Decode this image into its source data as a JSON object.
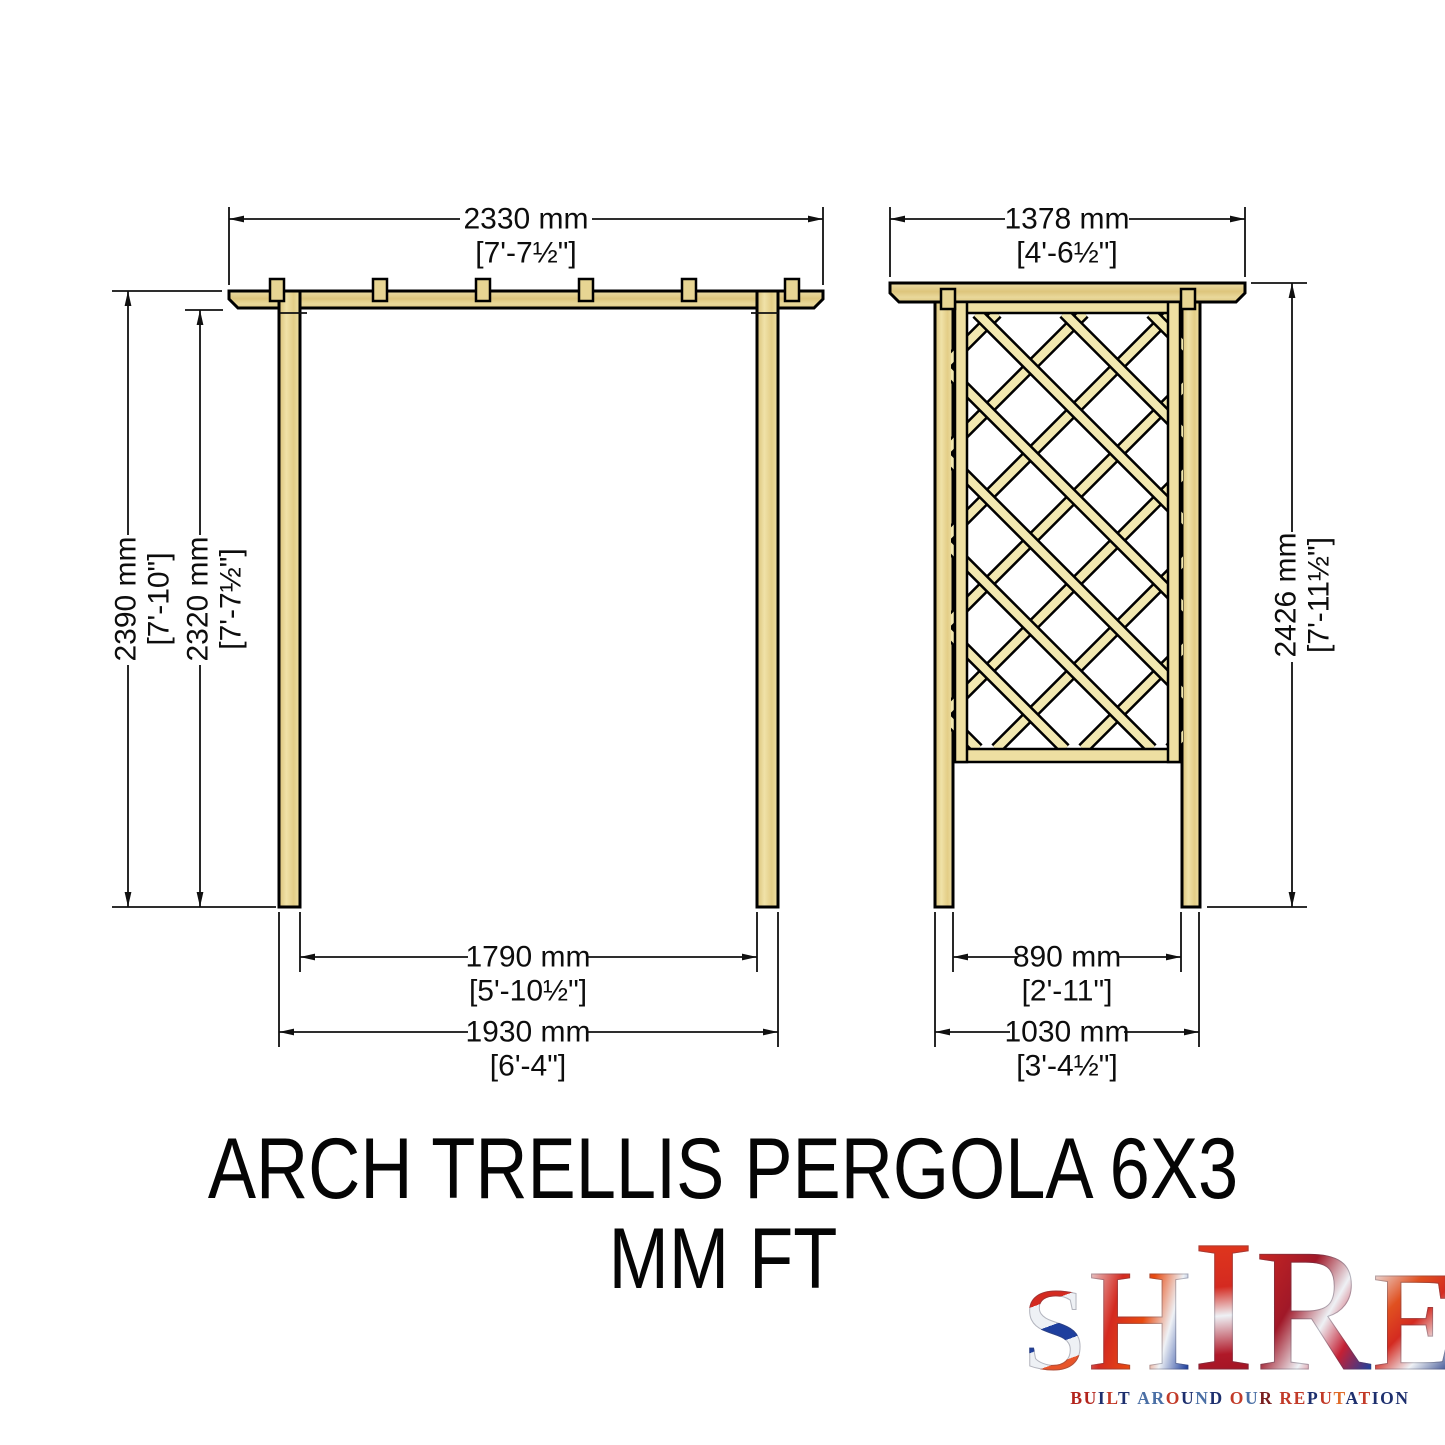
{
  "drawing": {
    "front_view": {
      "name": "pergola front elevation",
      "dim_top_width_mm": "2330 mm",
      "dim_top_width_ft": "[7'-7½\"]",
      "dim_height_outer_mm": "2390 mm",
      "dim_height_outer_ft": "[7'-10\"]",
      "dim_height_inner_mm": "2320 mm",
      "dim_height_inner_ft": "[7'-7½\"]",
      "dim_span_inner_mm": "1790 mm",
      "dim_span_inner_ft": "[5'-10½\"]",
      "dim_span_outer_mm": "1930 mm",
      "dim_span_outer_ft": "[6'-4\"]"
    },
    "side_view": {
      "name": "pergola side elevation with trellis",
      "dim_top_width_mm": "1378 mm",
      "dim_top_width_ft": "[4'-6½\"]",
      "dim_height_mm": "2426 mm",
      "dim_height_ft": "[7'-11½\"]",
      "dim_span_inner_mm": "890 mm",
      "dim_span_inner_ft": "[2'-11\"]",
      "dim_span_outer_mm": "1030 mm",
      "dim_span_outer_ft": "[3'-4½\"]"
    },
    "colors": {
      "wood": "#e6d193",
      "wood_light": "#f2e8b0",
      "outline": "#000000"
    }
  },
  "title": {
    "line1": "ARCH TRELLIS PERGOLA 6X3",
    "line2": "MM FT"
  },
  "logo": {
    "letters": [
      "S",
      "H",
      "I",
      "R",
      "E"
    ],
    "tagline": "BUILT AROUND OUR REPUTATION",
    "tagline_letters": [
      {
        "ch": "B",
        "color": "#b3241c"
      },
      {
        "ch": "U",
        "color": "#b3241c"
      },
      {
        "ch": "I",
        "color": "#1d2f6e"
      },
      {
        "ch": "L",
        "color": "#c23a28"
      },
      {
        "ch": "T",
        "color": "#1d2f6e"
      },
      {
        "ch": " "
      },
      {
        "ch": "A",
        "color": "#4a6fa5"
      },
      {
        "ch": "R",
        "color": "#4a6fa5"
      },
      {
        "ch": "O",
        "color": "#c23a28"
      },
      {
        "ch": "U",
        "color": "#1d2f6e"
      },
      {
        "ch": "N",
        "color": "#4a6fa5"
      },
      {
        "ch": "D",
        "color": "#1d2f6e"
      },
      {
        "ch": " "
      },
      {
        "ch": "O",
        "color": "#c23a28"
      },
      {
        "ch": "U",
        "color": "#4a6fa5"
      },
      {
        "ch": "R",
        "color": "#7a1f1f"
      },
      {
        "ch": " "
      },
      {
        "ch": "R",
        "color": "#c23a28"
      },
      {
        "ch": "E",
        "color": "#c23a28"
      },
      {
        "ch": "P",
        "color": "#1d2f6e"
      },
      {
        "ch": "U",
        "color": "#c23a28"
      },
      {
        "ch": "T",
        "color": "#e06b28"
      },
      {
        "ch": "A",
        "color": "#1d2f6e"
      },
      {
        "ch": "T",
        "color": "#c23a28"
      },
      {
        "ch": "I",
        "color": "#1d2f6e"
      },
      {
        "ch": "O",
        "color": "#1d2f6e"
      },
      {
        "ch": "N",
        "color": "#1d2f6e"
      }
    ],
    "colors": {
      "red": "#cf2b20",
      "blue": "#1e3f9e",
      "silver": "#eef1f5"
    }
  }
}
